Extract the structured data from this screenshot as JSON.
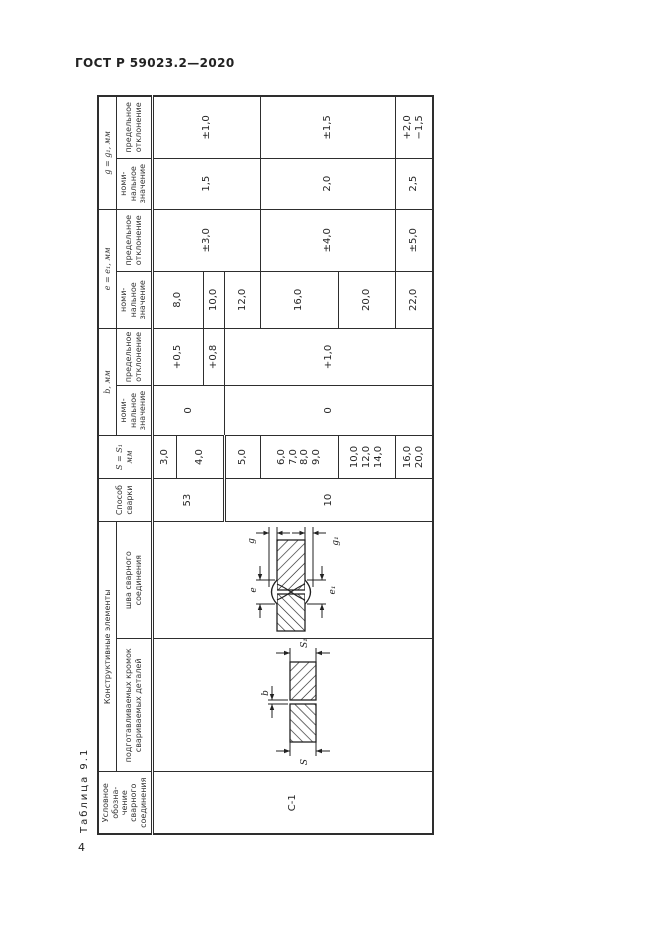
{
  "page": {
    "doc_header": "ГОСТ Р 59023.2—2020",
    "page_number": "4",
    "table_caption": "Таблица 9.1"
  },
  "table": {
    "headers": {
      "designation": "Условное\nобозна-\nчение\nсварного\nсоединения",
      "construct_group": "Конструктивные элементы",
      "edges": "подготавливаемых кромок\nсвариваемых деталей",
      "weld": "шва сварного\nсоединения",
      "method": "Способ\nсварки",
      "s_col": "S = S₁\nмм",
      "b_group": "b, мм",
      "e_group": "e = e₁, мм",
      "g_group": "g = g₁, мм",
      "nominal": "номи-\nнальное\nзначение",
      "deviation": "предельное\nотклонение"
    },
    "values": {
      "designation": "С-1",
      "method": [
        "53",
        "10"
      ],
      "s": [
        "3,0",
        "4,0",
        "5,0",
        "6,0\n7,0\n8,0\n9,0",
        "10,0\n12,0\n14,0",
        "16,0\n20,0"
      ],
      "b_nom": [
        "0",
        "0"
      ],
      "b_dev": [
        "+0,5",
        "+0,8",
        "+1,0"
      ],
      "e_nom": [
        "8,0",
        "10,0",
        "12,0",
        "16,0",
        "20,0",
        "22,0"
      ],
      "e_dev": [
        "±3,0",
        "±4,0",
        "±5,0"
      ],
      "g_nom": [
        "1,5",
        "2,0",
        "2,5"
      ],
      "g_dev": [
        "±1,0",
        "±1,5",
        "+2,0\n−1,5"
      ]
    },
    "diagram_labels": {
      "s": "S",
      "s1": "S₁",
      "b": "b",
      "e": "e",
      "e1": "e₁",
      "g": "g",
      "g1": "g₁"
    }
  }
}
